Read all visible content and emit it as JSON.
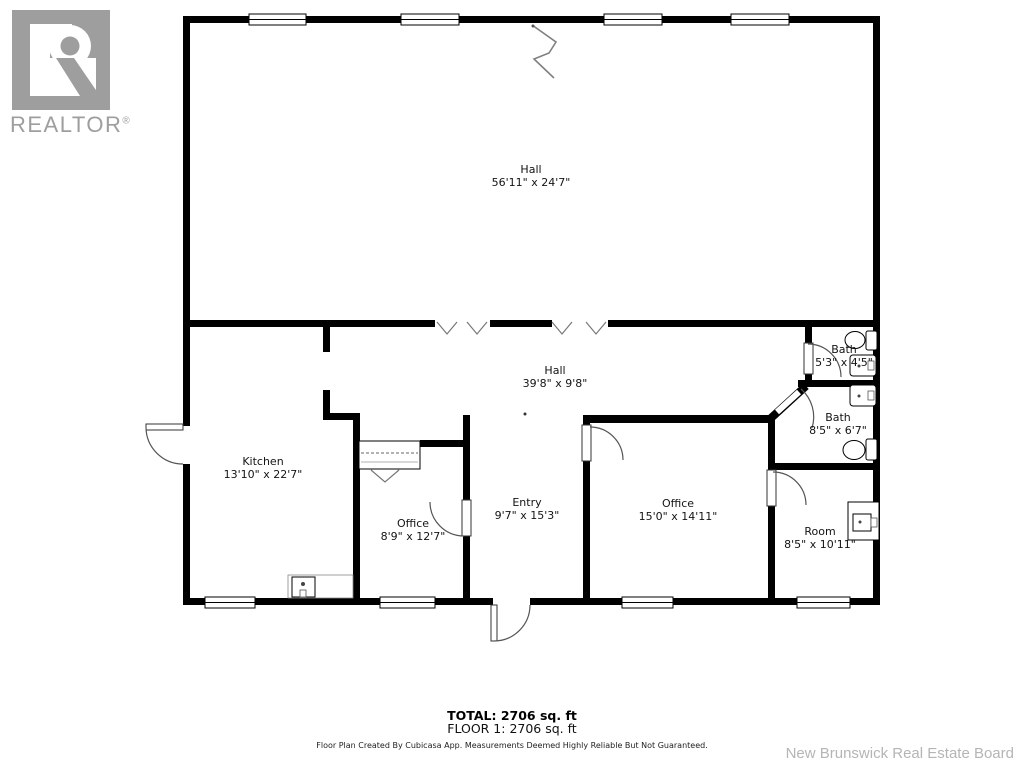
{
  "logo": {
    "realtor_text": "REALTOR",
    "registered_mark": "®"
  },
  "rooms": [
    {
      "name": "Hall",
      "dims": "56'11\" x 24'7\""
    },
    {
      "name": "Hall",
      "dims": "39'8\" x 9'8\""
    },
    {
      "name": "Kitchen",
      "dims": "13'10\" x 22'7\""
    },
    {
      "name": "Office",
      "dims": "8'9\" x 12'7\""
    },
    {
      "name": "Entry",
      "dims": "9'7\" x 15'3\""
    },
    {
      "name": "Office",
      "dims": "15'0\" x 14'11\""
    },
    {
      "name": "Bath",
      "dims": "5'3\" x 4'5\""
    },
    {
      "name": "Bath",
      "dims": "8'5\" x 6'7\""
    },
    {
      "name": "Room",
      "dims": "8'5\" x 10'11\""
    }
  ],
  "footer": {
    "total": "TOTAL: 2706 sq. ft",
    "floor": "FLOOR 1: 2706 sq. ft",
    "disclaimer": "Floor Plan Created By Cubicasa App. Measurements Deemed Highly Reliable But Not Guaranteed.",
    "watermark": "New Brunswick Real Estate Board"
  },
  "colors": {
    "wall": "#000000",
    "logo_gray": "#9e9e9e",
    "watermark_gray": "#b5b5b5",
    "door_arc": "#555555",
    "chevron": "#777777"
  }
}
